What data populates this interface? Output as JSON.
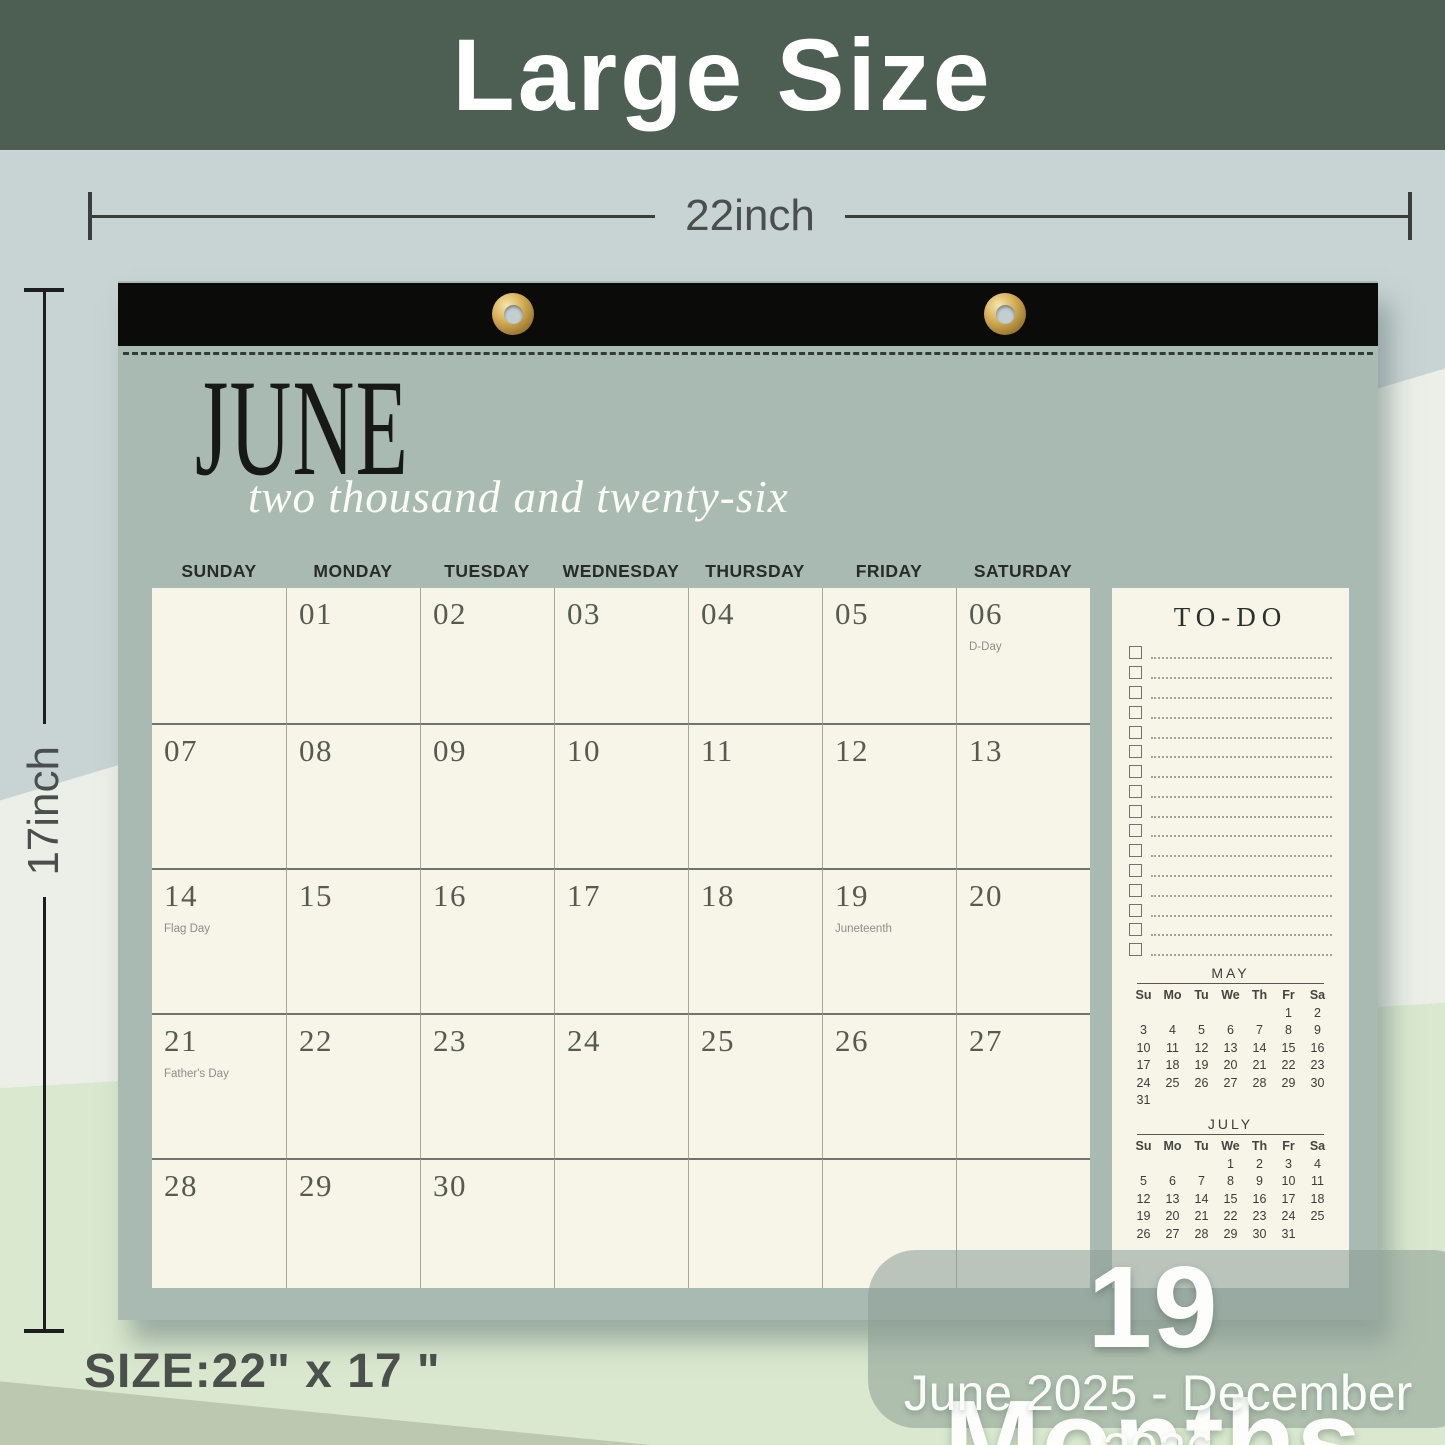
{
  "banner": {
    "title": "Large Size"
  },
  "annotations": {
    "width_label": "22inch",
    "height_label": "17inch",
    "size_label": "SIZE:22\" x 17 \""
  },
  "badge": {
    "title": "19 Months",
    "subtitle": "June 2025 - December 2026"
  },
  "calendar": {
    "month_title": "JUNE",
    "year_script": "two thousand and twenty-six",
    "weekday_headers": [
      "SUNDAY",
      "MONDAY",
      "TUESDAY",
      "WEDNESDAY",
      "THURSDAY",
      "FRIDAY",
      "SATURDAY"
    ],
    "cells": [
      {
        "date": "",
        "holiday": ""
      },
      {
        "date": "01",
        "holiday": ""
      },
      {
        "date": "02",
        "holiday": ""
      },
      {
        "date": "03",
        "holiday": ""
      },
      {
        "date": "04",
        "holiday": ""
      },
      {
        "date": "05",
        "holiday": ""
      },
      {
        "date": "06",
        "holiday": "D-Day"
      },
      {
        "date": "07",
        "holiday": ""
      },
      {
        "date": "08",
        "holiday": ""
      },
      {
        "date": "09",
        "holiday": ""
      },
      {
        "date": "10",
        "holiday": ""
      },
      {
        "date": "11",
        "holiday": ""
      },
      {
        "date": "12",
        "holiday": ""
      },
      {
        "date": "13",
        "holiday": ""
      },
      {
        "date": "14",
        "holiday": "Flag Day"
      },
      {
        "date": "15",
        "holiday": ""
      },
      {
        "date": "16",
        "holiday": ""
      },
      {
        "date": "17",
        "holiday": ""
      },
      {
        "date": "18",
        "holiday": ""
      },
      {
        "date": "19",
        "holiday": "Juneteenth"
      },
      {
        "date": "20",
        "holiday": ""
      },
      {
        "date": "21",
        "holiday": "Father's Day"
      },
      {
        "date": "22",
        "holiday": ""
      },
      {
        "date": "23",
        "holiday": ""
      },
      {
        "date": "24",
        "holiday": ""
      },
      {
        "date": "25",
        "holiday": ""
      },
      {
        "date": "26",
        "holiday": ""
      },
      {
        "date": "27",
        "holiday": ""
      },
      {
        "date": "28",
        "holiday": ""
      },
      {
        "date": "29",
        "holiday": ""
      },
      {
        "date": "30",
        "holiday": ""
      },
      {
        "date": "",
        "holiday": ""
      },
      {
        "date": "",
        "holiday": ""
      },
      {
        "date": "",
        "holiday": ""
      },
      {
        "date": "",
        "holiday": ""
      }
    ]
  },
  "todo": {
    "title": "TO-DO",
    "row_count": 16
  },
  "mini_calendars": [
    {
      "title": "MAY",
      "headers": [
        "Su",
        "Mo",
        "Tu",
        "We",
        "Th",
        "Fr",
        "Sa"
      ],
      "rows": [
        [
          "",
          "",
          "",
          "",
          "",
          "1",
          "2"
        ],
        [
          "3",
          "4",
          "5",
          "6",
          "7",
          "8",
          "9"
        ],
        [
          "10",
          "11",
          "12",
          "13",
          "14",
          "15",
          "16"
        ],
        [
          "17",
          "18",
          "19",
          "20",
          "21",
          "22",
          "23"
        ],
        [
          "24",
          "25",
          "26",
          "27",
          "28",
          "29",
          "30"
        ],
        [
          "31",
          "",
          "",
          "",
          "",
          "",
          ""
        ]
      ]
    },
    {
      "title": "JULY",
      "headers": [
        "Su",
        "Mo",
        "Tu",
        "We",
        "Th",
        "Fr",
        "Sa"
      ],
      "rows": [
        [
          "",
          "",
          "",
          "1",
          "2",
          "3",
          "4"
        ],
        [
          "5",
          "6",
          "7",
          "8",
          "9",
          "10",
          "11"
        ],
        [
          "12",
          "13",
          "14",
          "15",
          "16",
          "17",
          "18"
        ],
        [
          "19",
          "20",
          "21",
          "22",
          "23",
          "24",
          "25"
        ],
        [
          "26",
          "27",
          "28",
          "29",
          "30",
          "31",
          ""
        ]
      ]
    }
  ],
  "colors": {
    "banner_bg": "#4d5f53",
    "bg_blue_gray": "#c8d4d4",
    "bg_off_white": "#ecefe8",
    "bg_green": "#d9e8ce",
    "bg_corner_green": "#bcc8af",
    "calendar_body": "#a9bab3",
    "paper_cream": "#f7f4e8",
    "binding_black": "#0b0b09",
    "grommet_gold": "#d8b158",
    "badge_bg": "rgba(139,156,147,0.55)"
  }
}
